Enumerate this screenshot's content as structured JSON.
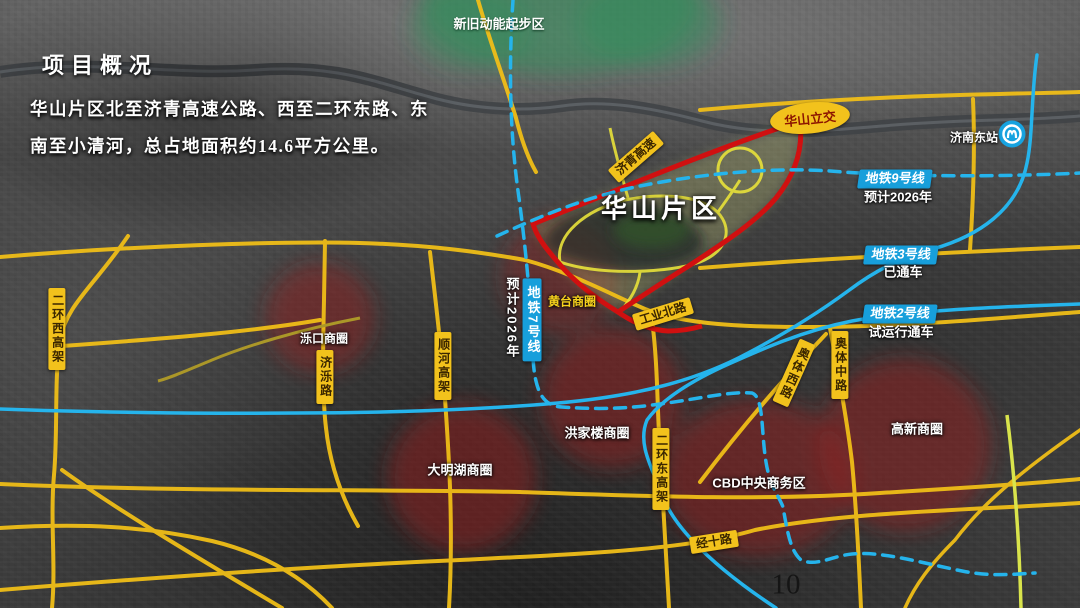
{
  "slide": {
    "title": "项目概况",
    "body_lines": [
      "华山片区北至济青高速公路、西至二环东路、东",
      "南至小清河，总占地面积约14.6平方公里。"
    ],
    "page_number": "10"
  },
  "overlay": {
    "green_zone_label": "新旧动能起步区",
    "district_label": "华山片区",
    "interchange_label": "华山立交",
    "station_label": "济南东站",
    "highway_label": "济青高速"
  },
  "metro_lines": [
    {
      "badge": "地铁9号线",
      "status": "预计2026年"
    },
    {
      "badge": "地铁3号线",
      "status": "已通车"
    },
    {
      "badge": "地铁2号线",
      "status": "试运行通车"
    },
    {
      "badge": "地铁7号线",
      "status": "预计2026年"
    }
  ],
  "roads": [
    {
      "label": "二环西高架"
    },
    {
      "label": "济泺路"
    },
    {
      "label": "顺河高架"
    },
    {
      "label": "工业北路"
    },
    {
      "label": "二环东高架"
    },
    {
      "label": "奥体西路"
    },
    {
      "label": "奥体中路"
    },
    {
      "label": "经十路"
    }
  ],
  "districts": [
    {
      "label": "泺口商圈"
    },
    {
      "label": "黄台商圈"
    },
    {
      "label": "大明湖商圈"
    },
    {
      "label": "洪家楼商圈"
    },
    {
      "label": "CBD中央商务区"
    },
    {
      "label": "高新商圈"
    }
  ],
  "colors": {
    "road_yellow": "#f0be18",
    "metro_cyan": "#25b4ec",
    "boundary_red": "#d01010",
    "district_red": "#8c2222",
    "zone_green": "#2e8f5a",
    "badge_blue": "#179fdb"
  }
}
